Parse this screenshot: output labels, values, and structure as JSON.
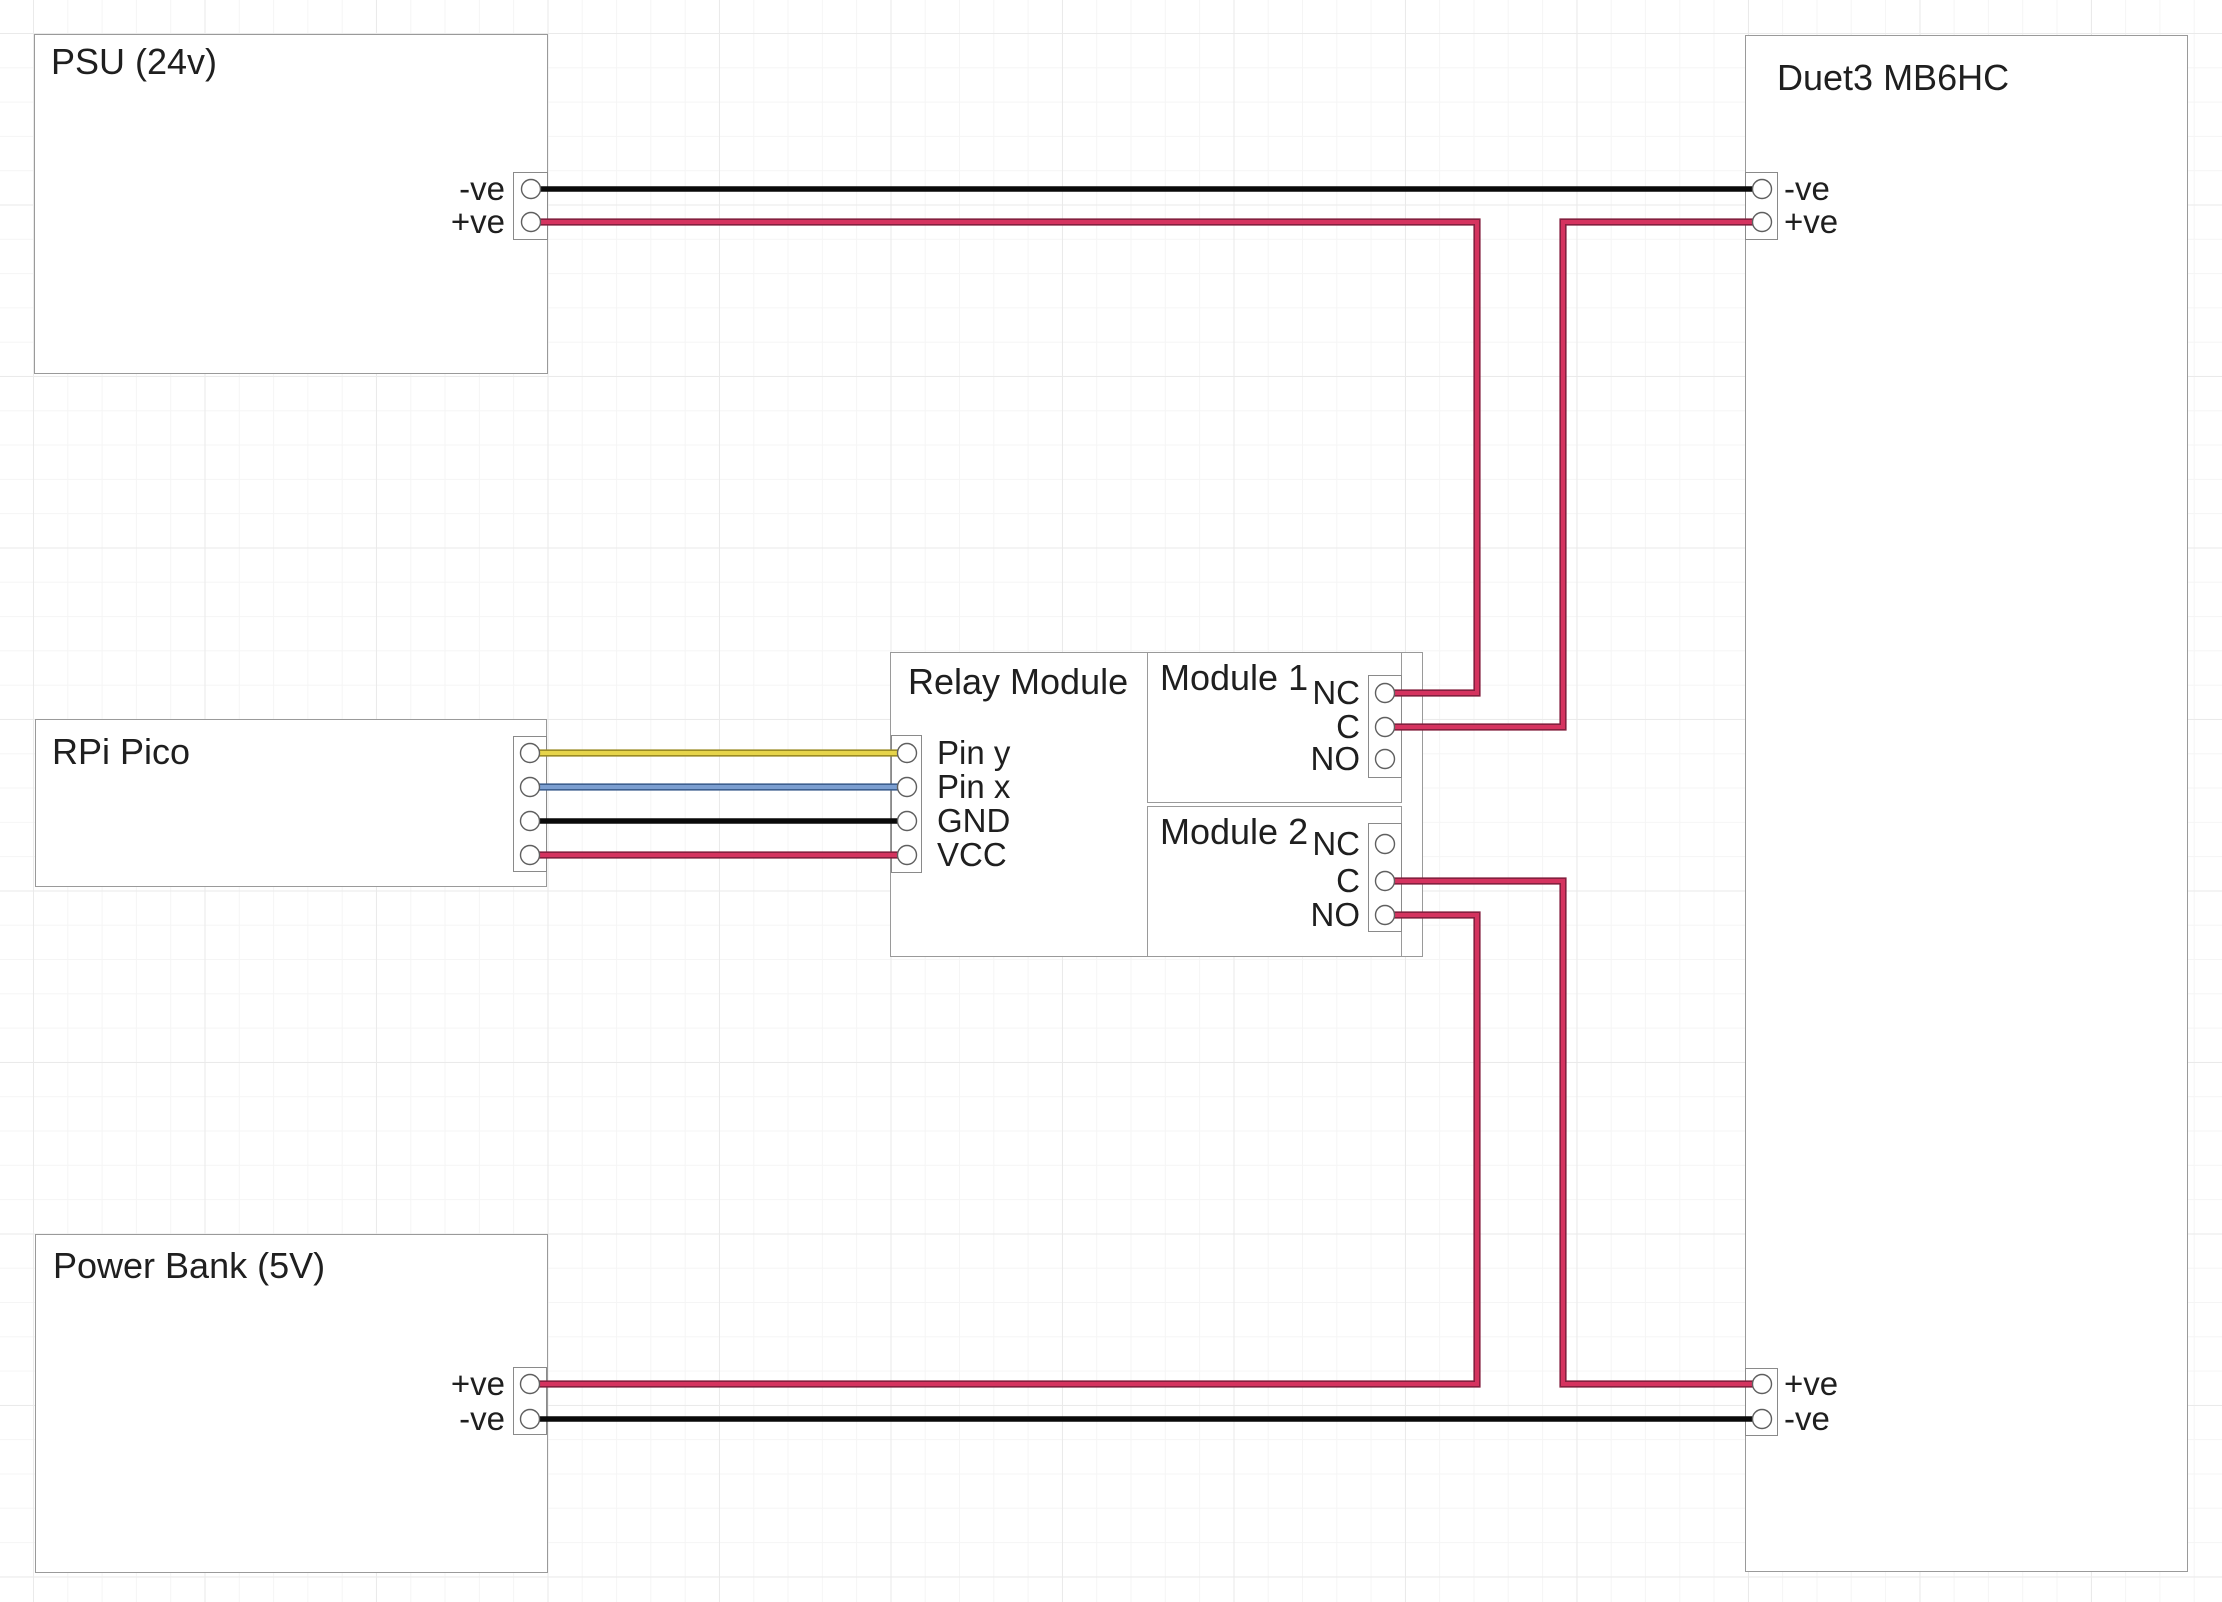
{
  "components": {
    "psu": {
      "title": "PSU (24v)",
      "pins": {
        "neg": "-ve",
        "pos": "+ve"
      }
    },
    "duet": {
      "title": "Duet3 MB6HC",
      "top_pins": {
        "neg": "-ve",
        "pos": "+ve"
      },
      "bottom_pins": {
        "pos": "+ve",
        "neg": "-ve"
      }
    },
    "rpi": {
      "title": "RPi Pico"
    },
    "relay": {
      "title": "Relay Module",
      "pins": {
        "pin_y": "Pin y",
        "pin_x": "Pin x",
        "gnd": "GND",
        "vcc": "VCC"
      }
    },
    "module1": {
      "title": "Module 1",
      "pins": {
        "nc": "NC",
        "c": "C",
        "no": "NO"
      }
    },
    "module2": {
      "title": "Module 2",
      "pins": {
        "nc": "NC",
        "c": "C",
        "no": "NO"
      }
    },
    "power_bank": {
      "title": "Power Bank (5V)",
      "pins": {
        "pos": "+ve",
        "neg": "-ve"
      }
    }
  },
  "connections": [
    {
      "from": "PSU -ve",
      "to": "Duet3 MB6HC -ve",
      "color": "black"
    },
    {
      "from": "PSU +ve",
      "to": "Relay Module 1 NC",
      "color": "red"
    },
    {
      "from": "Duet3 MB6HC +ve",
      "to": "Relay Module 1 C",
      "color": "red"
    },
    {
      "from": "RPi Pico pin 1",
      "to": "Relay Module Pin y",
      "color": "yellow"
    },
    {
      "from": "RPi Pico pin 2",
      "to": "Relay Module Pin x",
      "color": "blue"
    },
    {
      "from": "RPi Pico pin 3",
      "to": "Relay Module GND",
      "color": "black"
    },
    {
      "from": "RPi Pico pin 4",
      "to": "Relay Module VCC",
      "color": "red"
    },
    {
      "from": "Relay Module 2 C",
      "to": "Duet3 MB6HC +ve (bottom)",
      "color": "red"
    },
    {
      "from": "Relay Module 2 NO",
      "to": "Power Bank +ve",
      "color": "red"
    },
    {
      "from": "Power Bank -ve",
      "to": "Duet3 MB6HC -ve (bottom)",
      "color": "black"
    }
  ],
  "colors": {
    "wire_black": "#0a0a0a",
    "wire_red_core": "#d5335f",
    "wire_red_edge": "#84203f",
    "wire_yellow_core": "#e6d44a",
    "wire_yellow_edge": "#9a8b24",
    "wire_blue_core": "#7b9ed0",
    "wire_blue_edge": "#3d5f8f"
  }
}
